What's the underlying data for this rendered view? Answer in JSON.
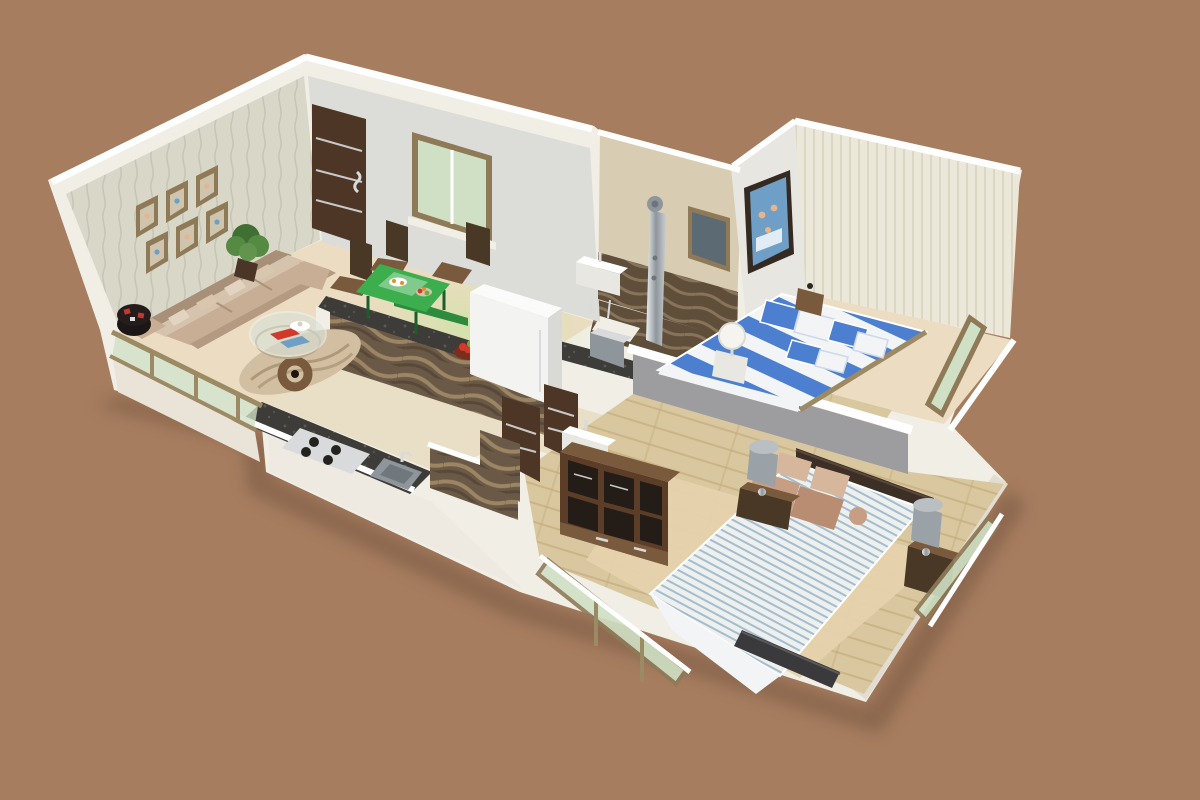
{
  "scene": {
    "label": "Isometric 3D rendered floor plan of a two-bedroom apartment on a brown background",
    "view": "isometric-3d-render",
    "rooms": [
      {
        "id": "living-room",
        "label": "Living room",
        "objects": [
          "beige-sofa",
          "throw-pillows",
          "round-patterned-pouf",
          "potted-plant",
          "glass-coffee-table",
          "magazines",
          "serving-tray",
          "area-rug",
          "curved-wood-side-table",
          "six-wall-photo-frames",
          "textured-feature-wall",
          "entrance-door",
          "window"
        ]
      },
      {
        "id": "dining-area",
        "label": "Dining area",
        "objects": [
          "green-glass-dining-table",
          "wooden-chairs",
          "fruit-platter",
          "juice-tray",
          "window"
        ]
      },
      {
        "id": "kitchen",
        "label": "Kitchen",
        "objects": [
          "granite-breakfast-bar",
          "wavy-pattern-base-wall",
          "gas-hob",
          "steel-sink",
          "refrigerator",
          "steel-cabinet-boxes",
          "fruit-bowl",
          "stone-wave-wall"
        ]
      },
      {
        "id": "bathroom",
        "label": "Bathroom",
        "objects": [
          "chrome-shower-panel",
          "wash-basin",
          "mosaic-tile-band",
          "mosaic-floor",
          "small-window"
        ]
      },
      {
        "id": "corridor",
        "label": "Passage",
        "objects": [
          "wooden-door",
          "wooden-door",
          "wash-basin",
          "stone-wave-wall"
        ]
      },
      {
        "id": "bedroom-1",
        "label": "Bedroom 1",
        "objects": [
          "blue-striped-double-bed",
          "blue-white-pillows",
          "white-ball-lamp",
          "bedside-table",
          "family-photo-frame",
          "striped-wall",
          "wood-strip-floor",
          "green-glass-window"
        ]
      },
      {
        "id": "bedroom-2",
        "label": "Bedroom 2",
        "objects": [
          "pinstripe-double-bed",
          "brown-pillows",
          "dark-headboard",
          "two-nightstands",
          "two-gray-lamps",
          "open-wardrobe-shelves",
          "tv-panel",
          "plank-wood-floor",
          "beige-carpet",
          "green-glass-windows"
        ]
      },
      {
        "id": "balcony",
        "label": "Balcony",
        "objects": [
          "glass-railing",
          "wood-railing-posts"
        ]
      }
    ]
  },
  "palette": {
    "bg": "#a77d5f",
    "ground_shadow": "#5e4430",
    "white": "#ffffff",
    "wall_white": "#f1eee6",
    "wall_face_shade": "#e9e3d8",
    "wall_face_shade2": "#eeeae1",
    "wall_face_shade3": "#e3ddd1",
    "wall_gray": "#dcdcd8",
    "wall_texture": "#d8d7c8",
    "texture_line": "#c3c2b2",
    "b1_wall": "#e8e6e1",
    "b1_wall_stripe_bg": "#ebe7d9",
    "b1_wall_stripe": "#dcd7c5",
    "bathroom_wall": "#d8cdb2",
    "mosaic_bg": "#5e4e3a",
    "mosaic_line": "#87745a",
    "divider_gray": "#9d9da0",
    "floor_cream": "#ecdcc2",
    "floor_light": "#e9dfc6",
    "green_light": "#b8e890",
    "plank_base": "#d9c79f",
    "plank_line": "#c4ad7f",
    "carpet": "#e6d2ac",
    "glass_green": "#cfe0c4",
    "glass_dark": "#5c6a74",
    "window_frame": "#8f7a58",
    "railing_wood": "#9c8a64",
    "door_wood": "#4d3626",
    "door_strip": "#c9c9c9",
    "wood_dark": "#4a3826",
    "wood_mid": "#7a5a3c",
    "granite": "#3e3c38",
    "steel": "#d8dadc",
    "steel_dark": "#8e969c",
    "wavy_bg": "#6b5947",
    "wavy_line": "#9c8563",
    "wavy_dark": "#574838",
    "sofa_dark": "#a88f78",
    "sofa_base": "#d6c3ad",
    "sofa_seat": "#c7ae95",
    "sofa_front": "#b49a81",
    "pillow_light": "#e2d4c0",
    "pillow_mid": "#d9c6ae",
    "pouf_dark": "#241d1c",
    "pouf_red": "#c03b2e",
    "plant_dark": "#3f6f33",
    "plant_mid": "#558a42",
    "plant_light": "#63944e",
    "table_green": "#3cae4e",
    "table_green_dark": "#2e8a3c",
    "bed_blue": "#4d7fd0",
    "bed_white": "#f2f4f6",
    "spread_bg": "#eef0ee",
    "spread_stripe": "#a3bdd0",
    "pillow_brown1": "#c79e83",
    "pillow_brown2": "#b88d72",
    "pillow_brown3": "#d7b79c",
    "headboard": "#3c2f26",
    "tv_dark": "#3a3a3c",
    "lamp_gray": "#9aa2a8",
    "lamp_shade_top": "#b9bfc3",
    "lamp_white": "#f6f4ee",
    "wardrobe_wood": "#5b3d28",
    "wardrobe_dark": "#241c16",
    "rug": "#d2bfa2",
    "rug_line": "#97805f",
    "photo_blue": "#6f9ec6",
    "skin": "#e8b48c",
    "frame_dark": "#352a22",
    "photo_mat": "#cfc4ae",
    "fruit_red": "#d2392a",
    "fruit_green": "#6fae3c",
    "fruit_orange": "#e0902c",
    "bowl_brown": "#7a2e1e"
  }
}
